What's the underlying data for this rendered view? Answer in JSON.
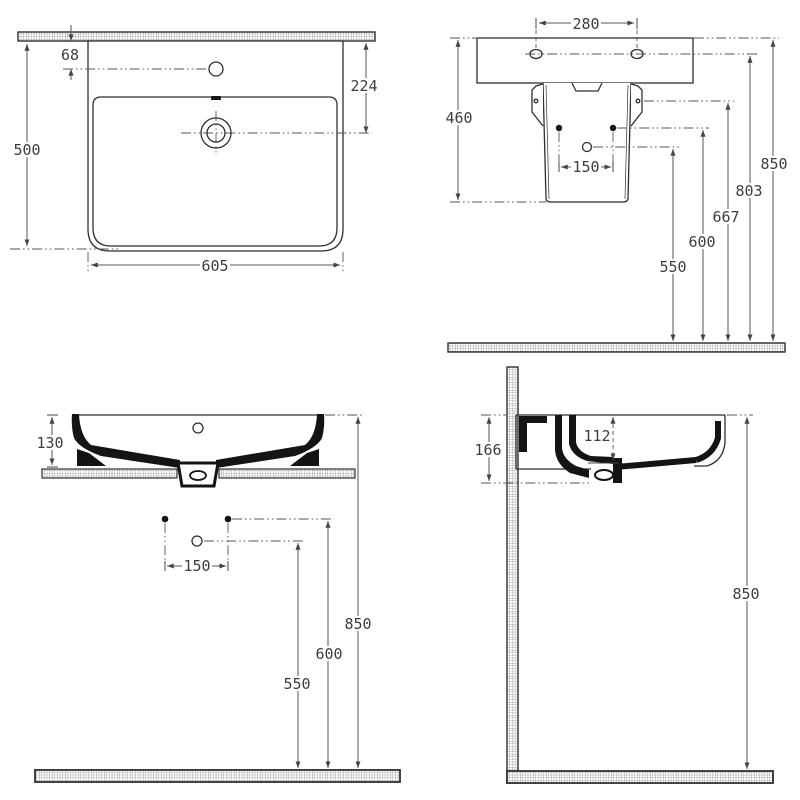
{
  "drawing": {
    "views": {
      "plan": {
        "dims": {
          "wall_to_tap": "68",
          "depth": "500",
          "tap_to_drain": "224",
          "width": "605"
        }
      },
      "rear": {
        "dims": {
          "fixing_centres": "280",
          "back_height": "460",
          "supply_centres": "150",
          "h_rim": "850",
          "h_fixing": "803",
          "h_bracket": "667",
          "h_supply": "600",
          "h_waste": "550"
        }
      },
      "front": {
        "dims": {
          "bowl_height": "130",
          "supply_centres": "150",
          "h_rim": "850",
          "h_supply": "600",
          "h_waste": "550"
        }
      },
      "side": {
        "dims": {
          "overall_height": "166",
          "bowl_depth": "112",
          "h_rim": "850"
        }
      }
    }
  }
}
